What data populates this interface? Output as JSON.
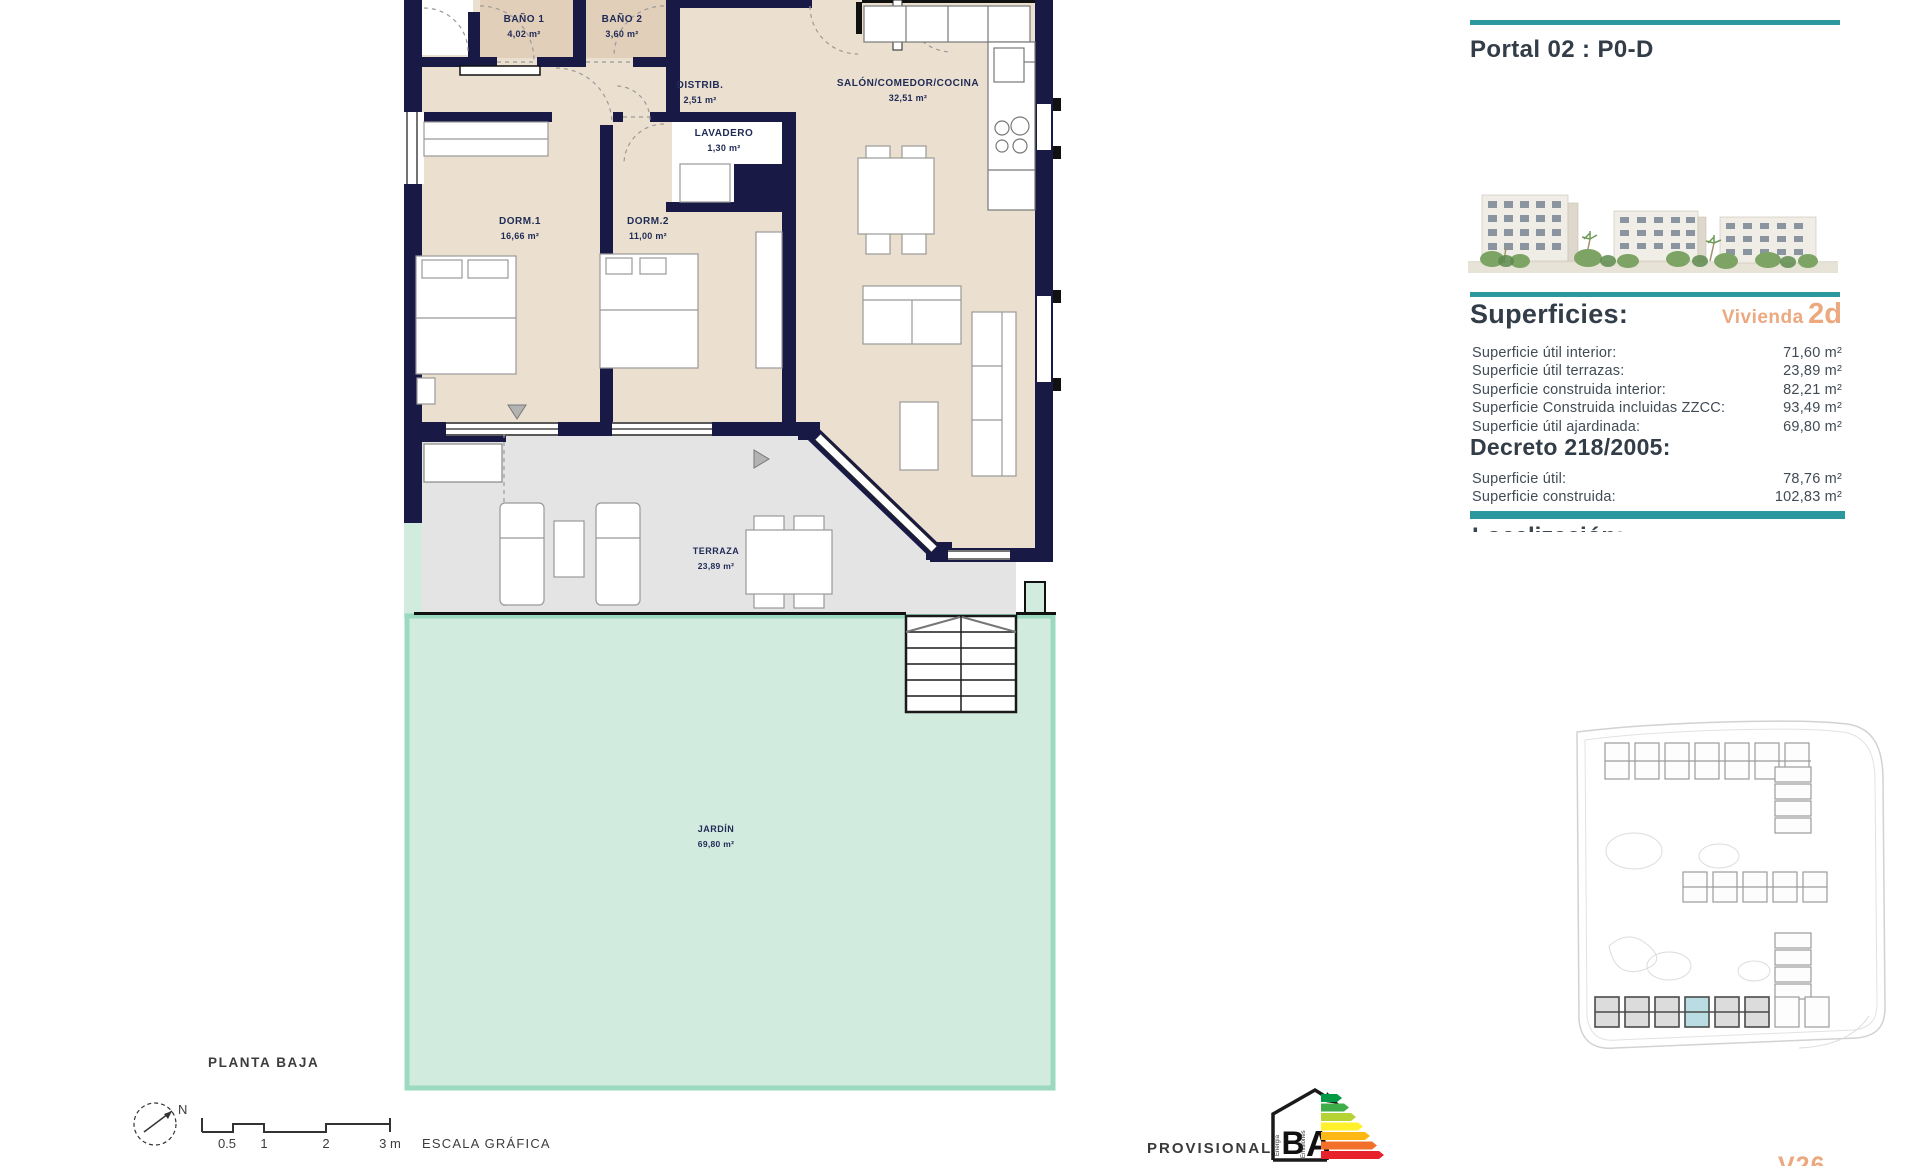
{
  "floor_plan": {
    "plan_title": "PLANTA BAJA",
    "north_label": "N",
    "scale_bar": {
      "tick_05": "0.5",
      "tick_1": "1",
      "tick_2": "2",
      "tick_3": "3 m",
      "caption": "ESCALA GRÁFICA"
    },
    "rooms": [
      {
        "name": "BAÑO 1",
        "area": "4,02 m²"
      },
      {
        "name": "BAÑO 2",
        "area": "3,60 m²"
      },
      {
        "name": "DISTRIB.",
        "area": "2,51 m²"
      },
      {
        "name": "SALÓN/COMEDOR/COCINA",
        "area": "32,51 m²"
      },
      {
        "name": "LAVADERO",
        "area": "1,30 m²"
      },
      {
        "name": "DORM.1",
        "area": "16,66 m²"
      },
      {
        "name": "DORM.2",
        "area": "11,00 m²"
      },
      {
        "name": "TERRAZA",
        "area": "23,89 m²"
      },
      {
        "name": "JARDÍN",
        "area": "69,80 m²"
      }
    ]
  },
  "sidebar": {
    "portal_title": "Portal 02 : P0-D",
    "superficies": {
      "heading": "Superficies:",
      "vivienda_word": "Vivienda",
      "vivienda_code": "2d",
      "rows": [
        {
          "label": "Superficie útil interior:",
          "value": "71,60 m²"
        },
        {
          "label": "Superficie útil terrazas:",
          "value": "23,89 m²"
        },
        {
          "label": "Superficie construida interior:",
          "value": "82,21 m²"
        },
        {
          "label": "Superficie Construida incluidas ZZCC:",
          "value": "93,49 m²"
        },
        {
          "label": "Superficie útil ajardinada:",
          "value": "69,80 m²"
        }
      ]
    },
    "decreto": {
      "heading": "Decreto 218/2005:",
      "rows": [
        {
          "label": "Superficie útil:",
          "value": "78,76 m²"
        },
        {
          "label": "Superficie construida:",
          "value": "102,83 m²"
        }
      ]
    },
    "clipped_heading": "Localización:"
  },
  "footer": {
    "provisional_label": "PROVISIONAL",
    "version_label": "V26",
    "energy": {
      "letter_b": "B",
      "letter_a": "A",
      "word_energia": "Energía",
      "word_emisiones": "Emisiones"
    }
  },
  "colors": {
    "teal": "#2a989c",
    "orange": "#eca87f",
    "wall_navy": "#191945",
    "interior_beige": "#ebe0d0",
    "bath_beige": "#e2cfba",
    "terrace_gray": "#e4e4e4",
    "garden_fill": "#d2ebdf",
    "garden_border": "#9bdac1",
    "highlight_unit": "#b9dde2"
  }
}
